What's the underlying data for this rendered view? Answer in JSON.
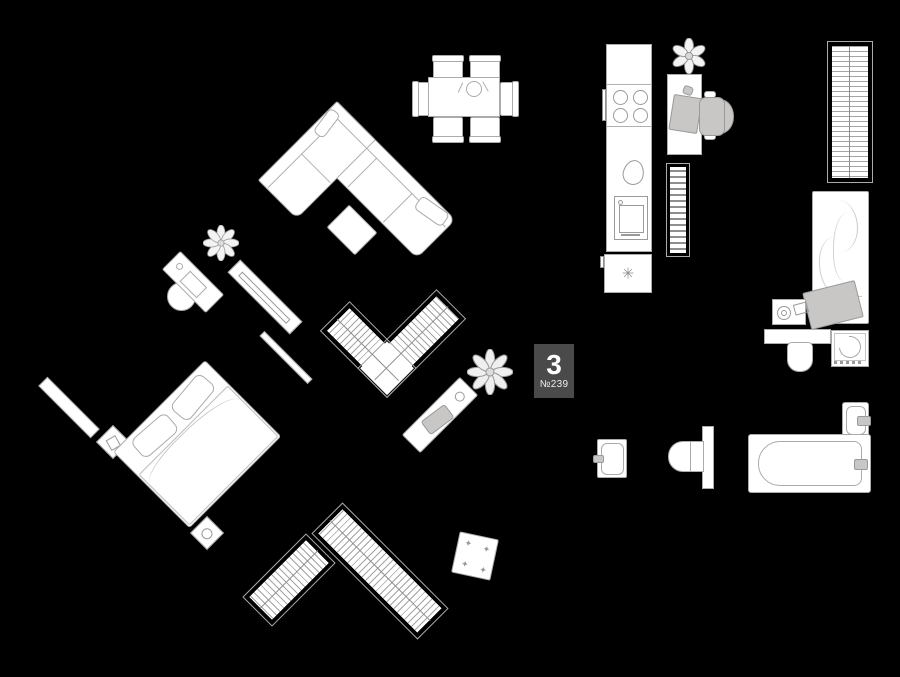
{
  "marker": {
    "number": "3",
    "apartment": "№239"
  },
  "icons": {
    "snowflake": "✳",
    "sparkle": "✦"
  },
  "palette": {
    "background": "#000000",
    "furniture_fill": "#ffffff",
    "outline": "#ababab",
    "accent_gray": "#c9c7c5",
    "marker_bg": "#4a4a4a",
    "marker_text": "#ffffff"
  },
  "furniture_inventory": [
    "dining-table-with-six-chairs",
    "corner-sofa",
    "sofa-pillows",
    "coffee-table",
    "potted-plants",
    "vanity-table-with-mirror",
    "stool",
    "tv-console",
    "wall-shelves",
    "double-bed",
    "nightstands",
    "corner-wardrobe",
    "console-shelf",
    "kitchen-counter",
    "cooktop",
    "kitchen-sink",
    "oven",
    "refrigerator",
    "bookshelf",
    "desk",
    "laptop",
    "office-chair",
    "tall-wardrobe",
    "single-bed",
    "bedside-table",
    "vanity-sink",
    "washing-machine",
    "small-sink",
    "toilet",
    "bathtub",
    "hallway-wardrobes",
    "ottoman"
  ]
}
